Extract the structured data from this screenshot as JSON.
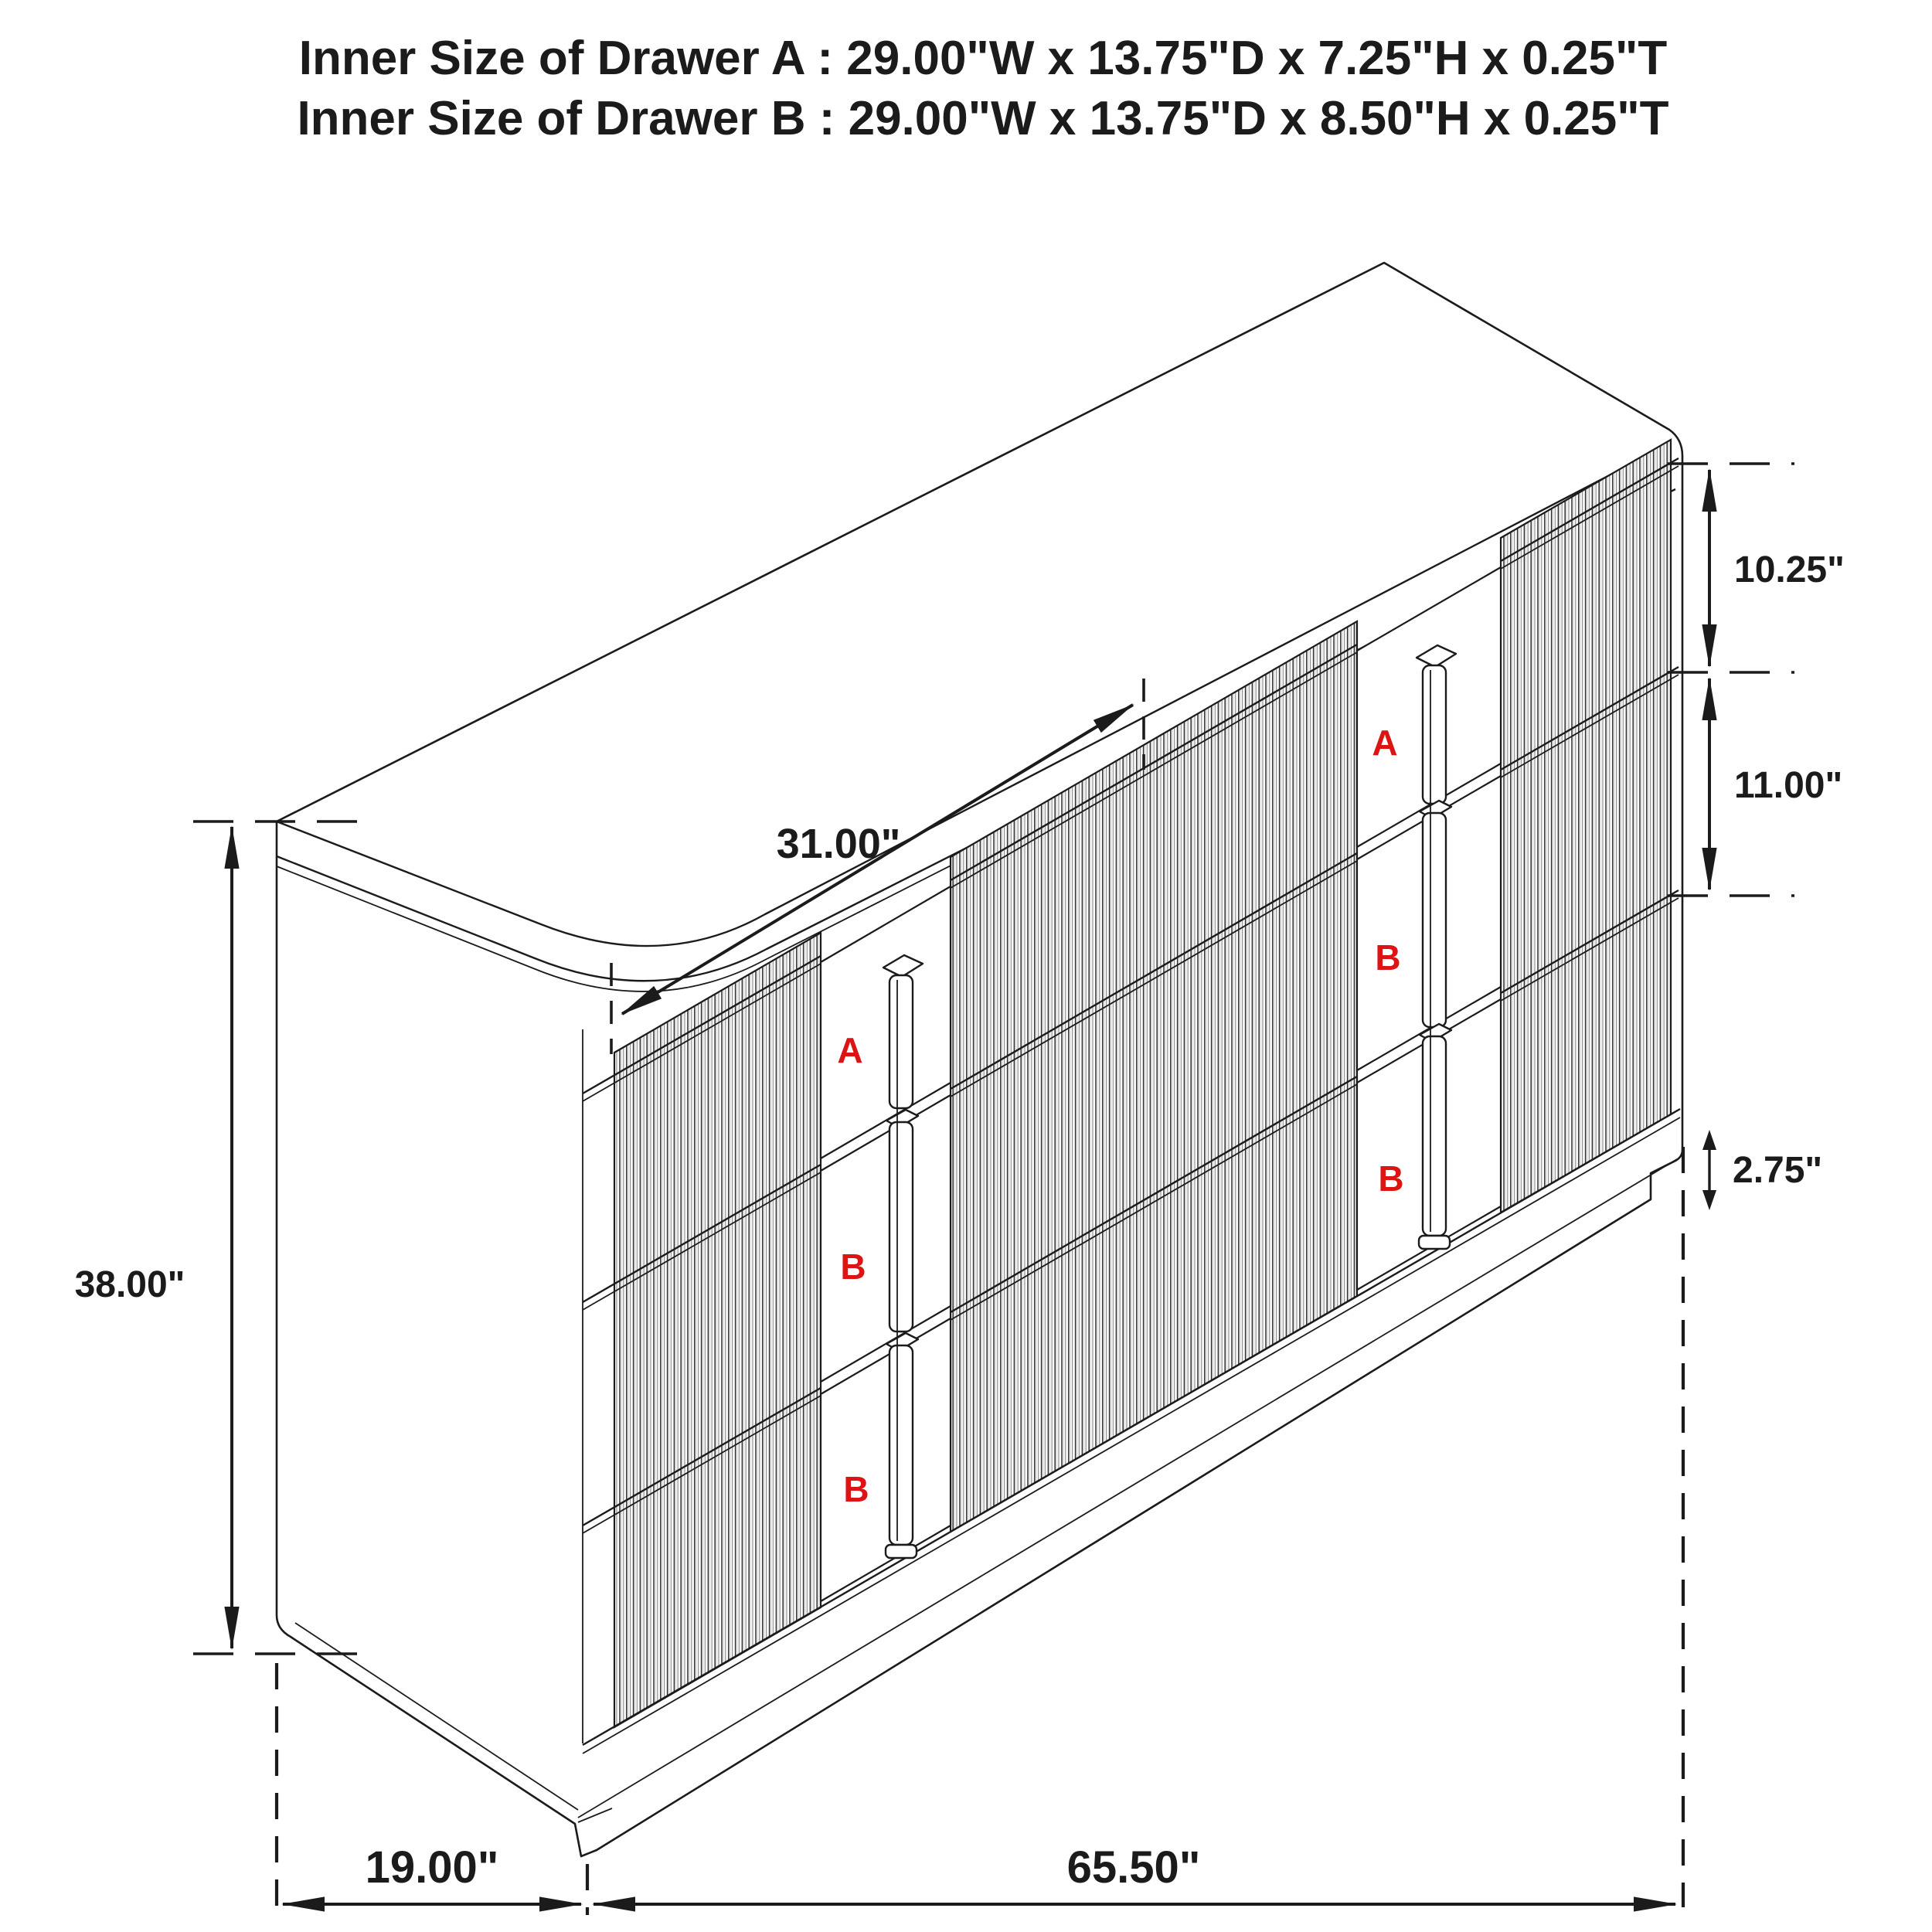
{
  "title": {
    "line1": "Inner Size of Drawer A : 29.00\"W x 13.75\"D x 7.25\"H x 0.25\"T",
    "line2": "Inner Size of Drawer B : 29.00\"W x 13.75\"D x 8.50\"H x 0.25\"T"
  },
  "dimensions": {
    "top_drawer_front_height": "10.25\"",
    "middle_drawer_front_height": "11.00\"",
    "base_height": "2.75\"",
    "overall_height": "38.00\"",
    "depth": "19.00\"",
    "overall_width": "65.50\"",
    "drawer_front_width": "31.00\""
  },
  "drawer_labels": {
    "left": [
      "A",
      "B",
      "B"
    ],
    "right": [
      "A",
      "B",
      "B"
    ]
  },
  "colors": {
    "line": "#1b1b1b",
    "accent_red": "#dd1414",
    "background": "#ffffff"
  }
}
